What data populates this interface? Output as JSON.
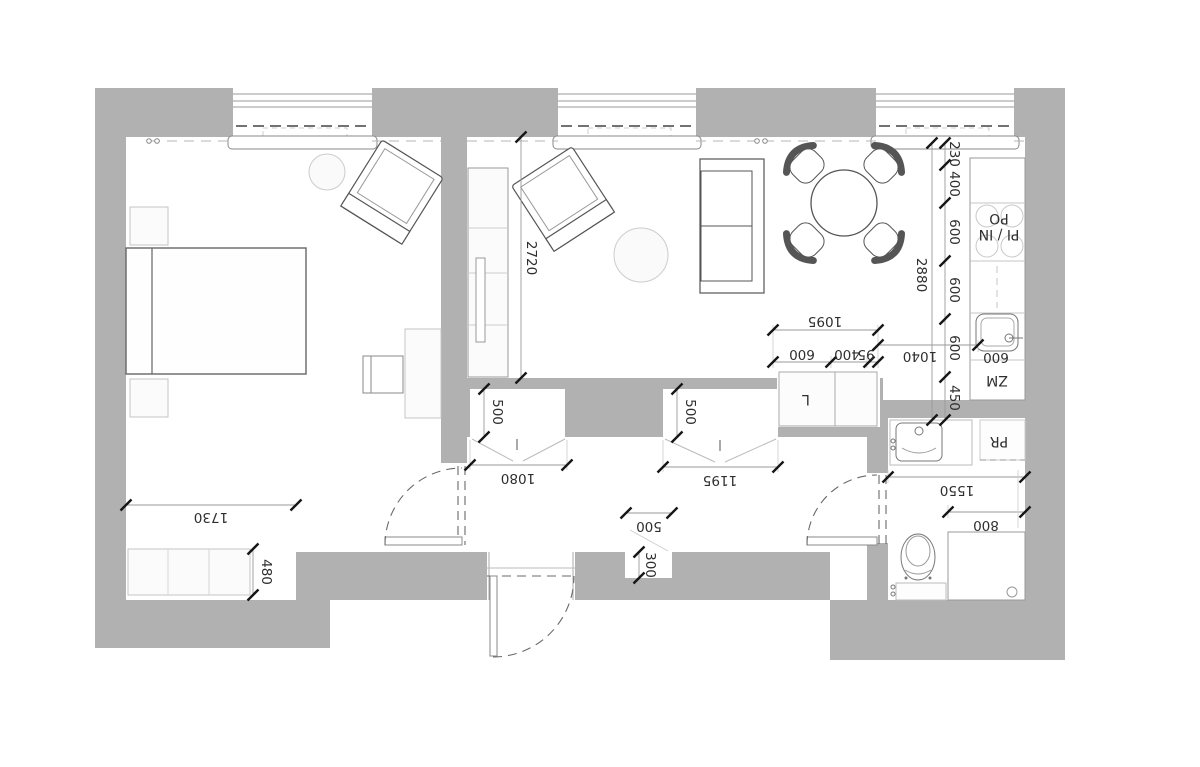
{
  "drawing": {
    "type": "apartment floor plan",
    "wall_color": "#b1b1b1"
  },
  "dims": {
    "living_width": "2720",
    "kitchen_total": "2880",
    "kitchen_chain": [
      "230",
      "400",
      "600",
      "600",
      "600",
      "450"
    ],
    "run_total": "1095",
    "run_chain": [
      "600",
      "400",
      "95"
    ],
    "fridge_width": "1040",
    "sink_width": "600",
    "niche1_depth": "500",
    "niche1_width": "1080",
    "niche2_depth": "500",
    "niche2_width": "1195",
    "entry_niche_width": "500",
    "entry_niche_depth": "300",
    "dresser_width": "1730",
    "dresser_depth": "480",
    "bath_width": "1550",
    "shower_width": "800"
  },
  "labels": {
    "oven": "PO",
    "hob": "PI / IN",
    "dishwasher": "ZM",
    "fridge": "L",
    "washer": "PR"
  }
}
